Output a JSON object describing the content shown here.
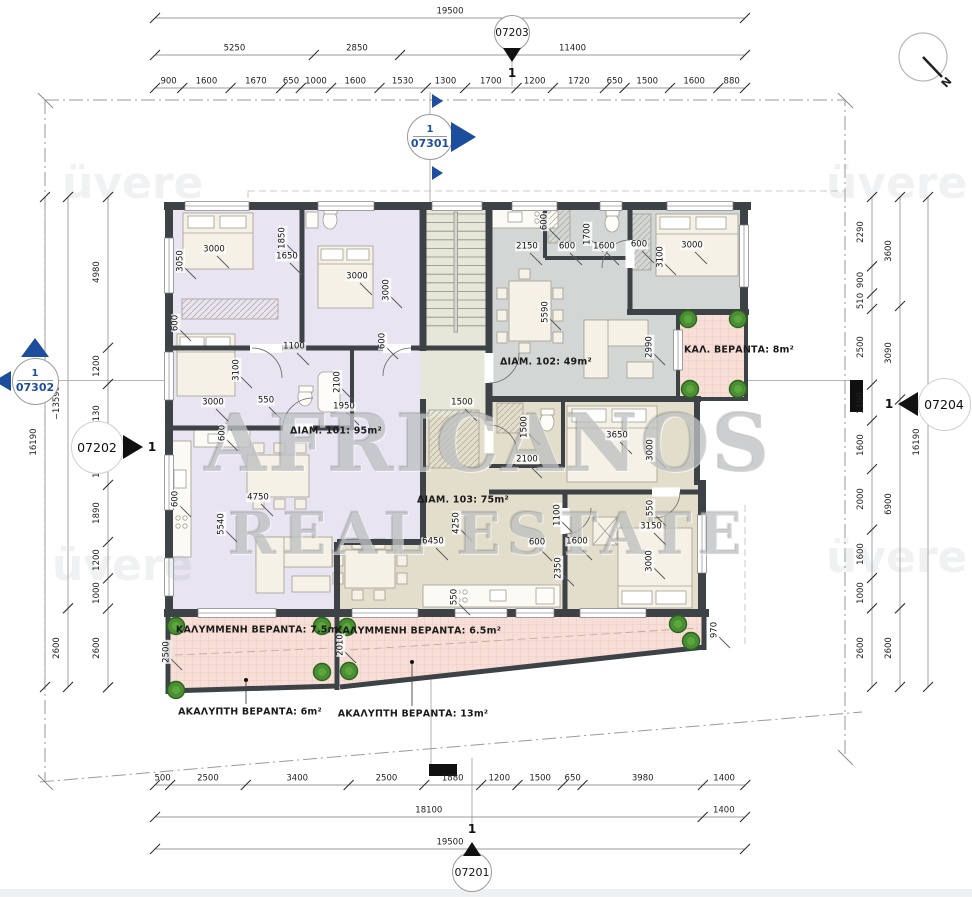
{
  "north": {
    "label": "N"
  },
  "watermark": {
    "line1": "AFRICANOS",
    "line2": "REAL ESTATE",
    "corner": "üvere"
  },
  "corner_watermarks": [
    {
      "x": 62,
      "y": 158
    },
    {
      "x": 826,
      "y": 158
    },
    {
      "x": 52,
      "y": 540
    },
    {
      "x": 826,
      "y": 532
    }
  ],
  "colors": {
    "apartment_101": "#e8e4f2",
    "apartment_102": "#d2d6d5",
    "apartment_103": "#e3decb",
    "stairwell": "#e6e7d8",
    "balcony": "#f7ded7",
    "wall": "#3d4247",
    "marker_blue": "#1d4e9e",
    "plant": "#4a8f33"
  },
  "area_labels": [
    {
      "text": "ΔΙΑΜ. 101: 95m²",
      "x": 290,
      "y": 431,
      "align": "left"
    },
    {
      "text": "ΔΙΑΜ. 102: 49m²",
      "x": 500,
      "y": 362,
      "align": "left"
    },
    {
      "text": "ΔΙΑΜ. 103: 75m²",
      "x": 417,
      "y": 500,
      "align": "left"
    },
    {
      "text": "ΚΑΛ. ΒΕΡΑΝΤΑ: 8m²",
      "x": 684,
      "y": 350,
      "align": "left"
    },
    {
      "text": "ΚΑΛΥΜΜΕΝΗ ΒΕΡΑΝΤΑ: 7.5m²",
      "x": 259,
      "y": 630,
      "align": "center"
    },
    {
      "text": "ΚΑΛΥΜΜΕΝΗ ΒΕΡΑΝΤΑ: 6.5m²",
      "x": 418,
      "y": 631,
      "align": "center"
    },
    {
      "text": "ΑΚΑΛΥΠΤΗ ΒΕΡΑΝΤΑ: 6m²",
      "x": 250,
      "y": 712,
      "align": "center"
    },
    {
      "text": "ΑΚΑΛΥΠΤΗ ΒΕΡΑΝΤΑ: 13m²",
      "x": 413,
      "y": 714,
      "align": "center"
    }
  ],
  "markers": [
    {
      "id": "07203",
      "x": 512,
      "y": 55,
      "type": "tri-down",
      "num": "1"
    },
    {
      "id": "07201",
      "x": 472,
      "y": 849,
      "type": "tri-up",
      "num": "1"
    },
    {
      "id": "07301",
      "x": 430,
      "y": 137,
      "type": "section-right",
      "num": "1"
    },
    {
      "id": "07302",
      "x": 35,
      "y": 381,
      "type": "section-up",
      "num": "1"
    },
    {
      "id": "07202",
      "x": 97,
      "y": 447,
      "type": "detail-right",
      "num": "1"
    },
    {
      "id": "07204",
      "x": 944,
      "y": 404,
      "type": "detail-left",
      "num": "1"
    }
  ],
  "dim_chains": [
    {
      "name": "top-overall",
      "dir": "h",
      "line": 18,
      "start": 155,
      "scale": 0.030256,
      "labels": [
        "19500"
      ]
    },
    {
      "name": "top-major",
      "dir": "h",
      "line": 55,
      "start": 155,
      "scale": 0.030256,
      "labels": [
        "5250",
        "2850",
        "11400"
      ]
    },
    {
      "name": "top-minor",
      "dir": "h",
      "line": 88,
      "start": 155,
      "scale": 0.030256,
      "labels": [
        "900",
        "1600",
        "1670",
        "650",
        "1000",
        "1600",
        "1530",
        "1300",
        "1700",
        "1200",
        "1720",
        "650",
        "1500",
        "1600",
        "880"
      ]
    },
    {
      "name": "bottom-minor",
      "dir": "h",
      "line": 785,
      "start": 155,
      "scale": 0.030256,
      "labels": [
        "500",
        "2500",
        "3400",
        "2500",
        "1880",
        "1200",
        "1500",
        "650",
        "3980",
        "1400"
      ]
    },
    {
      "name": "bottom-major",
      "dir": "h",
      "line": 817,
      "start": 155,
      "scale": 0.030256,
      "labels": [
        "18100",
        "1400"
      ]
    },
    {
      "name": "bottom-overall",
      "dir": "h",
      "line": 849,
      "start": 155,
      "scale": 0.030256,
      "labels": [
        "19500"
      ]
    },
    {
      "name": "left-outer",
      "dir": "v",
      "line": 45,
      "start": 197,
      "scale": 0.030266,
      "labels": [
        "16190"
      ]
    },
    {
      "name": "left-mid",
      "dir": "v",
      "line": 68,
      "start": 197,
      "scale": 0.030266,
      "labels": [
        "−13590",
        "2600"
      ]
    },
    {
      "name": "left-inner",
      "dir": "v",
      "line": 108,
      "start": 197,
      "scale": 0.030266,
      "labels": [
        "4980",
        "1200",
        "2130",
        "1200",
        "1890",
        "1200",
        "1000",
        "2600"
      ]
    },
    {
      "name": "right-inner",
      "dir": "v",
      "line": 872,
      "start": 197,
      "scale": 0.030266,
      "labels": [
        "2290",
        "900",
        "510",
        "2500",
        "1190",
        "1600",
        "2000",
        "1600",
        "1000",
        "2600"
      ]
    },
    {
      "name": "right-mid",
      "dir": "v",
      "line": 900,
      "start": 197,
      "scale": 0.030266,
      "labels": [
        "3600",
        "3090",
        "6900",
        "2600"
      ]
    },
    {
      "name": "right-outer",
      "dir": "v",
      "line": 928,
      "start": 197,
      "scale": 0.030266,
      "labels": [
        "16190"
      ]
    }
  ],
  "room_dims": [
    {
      "t": "3000",
      "x": 214,
      "y": 250
    },
    {
      "t": "3050",
      "x": 181,
      "y": 261,
      "r": 1
    },
    {
      "t": "1850",
      "x": 283,
      "y": 238,
      "r": 1
    },
    {
      "t": "1650",
      "x": 287,
      "y": 257
    },
    {
      "t": "3000",
      "x": 357,
      "y": 277
    },
    {
      "t": "3000",
      "x": 387,
      "y": 290,
      "r": 1
    },
    {
      "t": "600",
      "x": 176,
      "y": 323,
      "r": 1
    },
    {
      "t": "1100",
      "x": 294,
      "y": 347
    },
    {
      "t": "3100",
      "x": 237,
      "y": 370,
      "r": 1
    },
    {
      "t": "2100",
      "x": 338,
      "y": 382,
      "r": 1
    },
    {
      "t": "1950",
      "x": 344,
      "y": 407
    },
    {
      "t": "3000",
      "x": 213,
      "y": 403
    },
    {
      "t": "550",
      "x": 266,
      "y": 401
    },
    {
      "t": "600",
      "x": 383,
      "y": 341,
      "r": 1
    },
    {
      "t": "600",
      "x": 223,
      "y": 433,
      "r": 1
    },
    {
      "t": "4750",
      "x": 258,
      "y": 498
    },
    {
      "t": "5540",
      "x": 222,
      "y": 524,
      "r": 1
    },
    {
      "t": "600",
      "x": 176,
      "y": 499,
      "r": 1
    },
    {
      "t": "1500",
      "x": 462,
      "y": 403
    },
    {
      "t": "600",
      "x": 545,
      "y": 222,
      "r": 1
    },
    {
      "t": "2150",
      "x": 527,
      "y": 247
    },
    {
      "t": "600",
      "x": 567,
      "y": 247
    },
    {
      "t": "1700",
      "x": 588,
      "y": 234,
      "r": 1
    },
    {
      "t": "1600",
      "x": 604,
      "y": 247
    },
    {
      "t": "600",
      "x": 639,
      "y": 245
    },
    {
      "t": "3100",
      "x": 661,
      "y": 257,
      "r": 1
    },
    {
      "t": "3000",
      "x": 692,
      "y": 246
    },
    {
      "t": "5590",
      "x": 546,
      "y": 312,
      "r": 1
    },
    {
      "t": "2990",
      "x": 650,
      "y": 347,
      "r": 1
    },
    {
      "t": "1500",
      "x": 525,
      "y": 427,
      "r": 1
    },
    {
      "t": "2100",
      "x": 527,
      "y": 460
    },
    {
      "t": "3650",
      "x": 617,
      "y": 436
    },
    {
      "t": "3000",
      "x": 651,
      "y": 450,
      "r": 1
    },
    {
      "t": "550",
      "x": 651,
      "y": 508,
      "r": 1
    },
    {
      "t": "3150",
      "x": 651,
      "y": 527
    },
    {
      "t": "3000",
      "x": 650,
      "y": 561,
      "r": 1
    },
    {
      "t": "1100",
      "x": 558,
      "y": 515,
      "r": 1
    },
    {
      "t": "600",
      "x": 537,
      "y": 543
    },
    {
      "t": "1600",
      "x": 577,
      "y": 542
    },
    {
      "t": "2350",
      "x": 559,
      "y": 568,
      "r": 1
    },
    {
      "t": "4250",
      "x": 457,
      "y": 523,
      "r": 1
    },
    {
      "t": "6450",
      "x": 433,
      "y": 542
    },
    {
      "t": "550",
      "x": 455,
      "y": 597,
      "r": 1
    },
    {
      "t": "2500",
      "x": 167,
      "y": 652,
      "r": 1
    },
    {
      "t": "2010",
      "x": 341,
      "y": 645,
      "r": 1
    },
    {
      "t": "970",
      "x": 715,
      "y": 630,
      "r": 1
    }
  ]
}
